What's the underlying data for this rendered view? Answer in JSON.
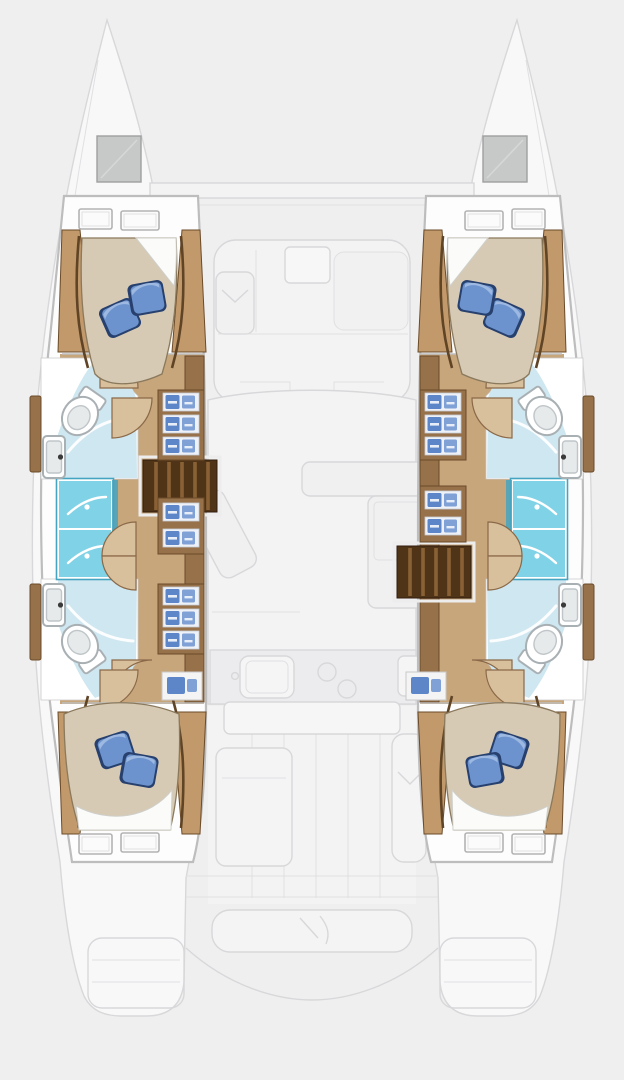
{
  "diagram": {
    "type": "boat-floor-plan",
    "vessel": "sailing catamaran",
    "view": "overhead accommodation plan, bow up",
    "summary": "4 cabins, 4 heads, 2 shower stalls per hull, ghosted deck plan in center",
    "port_hull": {
      "side": "left",
      "areas": [
        {
          "name": "bow-locker",
          "items": [
            "deck hatch"
          ]
        },
        {
          "name": "forward-cabin",
          "items": [
            "double berth",
            "2 blue pillows",
            "white duvet",
            "2 hull windows",
            "wood trim"
          ]
        },
        {
          "name": "forward-head",
          "items": [
            "toilet",
            "sink",
            "shower floor"
          ]
        },
        {
          "name": "shower-stalls",
          "items": [
            "forward shower stall",
            "aft shower stall"
          ]
        },
        {
          "name": "aft-head",
          "items": [
            "sink",
            "toilet",
            "shower floor"
          ]
        },
        {
          "name": "aft-cabin",
          "items": [
            "double berth",
            "2 blue pillows",
            "white duvet",
            "2 hull windows"
          ]
        },
        {
          "name": "companionway",
          "items": [
            "stairs",
            "storage shelves with linens",
            "doors"
          ]
        }
      ]
    },
    "starboard_hull": {
      "side": "right",
      "mirror_of": "port_hull"
    },
    "center_deck_ghosted": {
      "areas": [
        {
          "name": "foredeck-lounge",
          "items": [
            "U-seating",
            "table",
            "sun pads"
          ]
        },
        {
          "name": "saloon",
          "items": [
            "sofa",
            "dining table",
            "chaise"
          ]
        },
        {
          "name": "galley",
          "items": [
            "sink",
            "faucet",
            "stove burners"
          ]
        },
        {
          "name": "cockpit",
          "items": [
            "cockpit table",
            "bench seating"
          ]
        },
        {
          "name": "aft-bench",
          "items": [
            "transom bench"
          ]
        },
        {
          "name": "transom-steps",
          "items": [
            "port platform",
            "starboard platform"
          ]
        }
      ]
    }
  },
  "colors": {
    "background": "#efeff0",
    "ghost_fill": "#f3f3f4",
    "ghost_fill_dark": "#ececee",
    "deck_white": "#f8f8f9",
    "hull_white": "#fdfdfd",
    "hatch_gray": "#c7c9c9",
    "hatch_inner": "#b8bABA",
    "floor_wood": "#c7a67c",
    "floor_wood_light": "#d8c09c",
    "wood_mid": "#97714a",
    "wood_light": "#c2996a",
    "wood_dark": "#6b4b2a",
    "stairs_dark": "#503418",
    "mattress": "#d6cab5",
    "duvet_white": "#fbfbfa",
    "pillow_blue": "#6c93cd",
    "pillow_highlight": "#9db9e2",
    "pillow_dark": "#27406e",
    "shower_pale": "#cfe7f0",
    "shower_stall": "#80d2e6",
    "stall_trim": "#45a4c0",
    "fixture_fill": "#ffffff",
    "fixture_inner": "#e7eaea",
    "shelf_blue": "#5d86c8",
    "shelf_blue_alt": "#7fa1d6",
    "shelf_white": "#eef2f8",
    "window_white": "#fbfbfb"
  }
}
